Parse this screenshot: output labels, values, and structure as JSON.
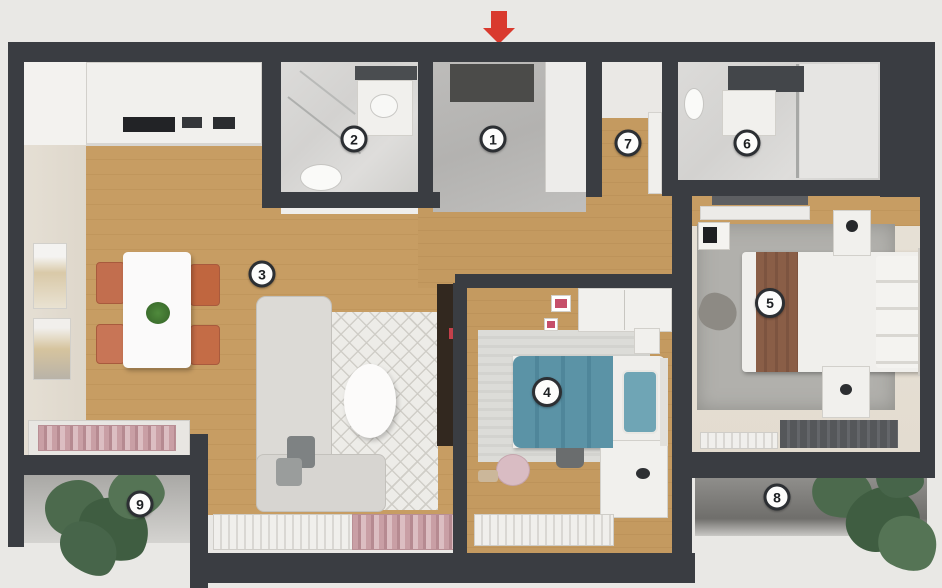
{
  "plan": {
    "type": "apartment-floor-plan-3d",
    "entrance_arrow": {
      "direction": "down",
      "color": "#d93a2e"
    },
    "rooms": [
      {
        "label": "1",
        "name": "entrance-hall"
      },
      {
        "label": "2",
        "name": "bathroom"
      },
      {
        "label": "3",
        "name": "living-room-kitchen"
      },
      {
        "label": "4",
        "name": "kids-bedroom"
      },
      {
        "label": "5",
        "name": "master-bedroom"
      },
      {
        "label": "6",
        "name": "bathroom-2"
      },
      {
        "label": "7",
        "name": "hallway"
      },
      {
        "label": "8",
        "name": "balcony"
      },
      {
        "label": "9",
        "name": "balcony-2"
      }
    ],
    "colors": {
      "background": "#e9e8e5",
      "wall": "#3a3d42",
      "wood_floor": "#c79d63",
      "bathroom_tile": "#d8d7d5",
      "entrance_tile": "#b8b7b5",
      "accent_red": "#d93a2e",
      "chair_terracotta": "#c26e4e",
      "kids_bed_teal": "#5b93a6",
      "master_bed_runner_brown": "#8a5e47",
      "plant_green": "#4c6a4d",
      "marker_background": "#fdfdfc",
      "marker_border": "#2c2f33"
    }
  }
}
